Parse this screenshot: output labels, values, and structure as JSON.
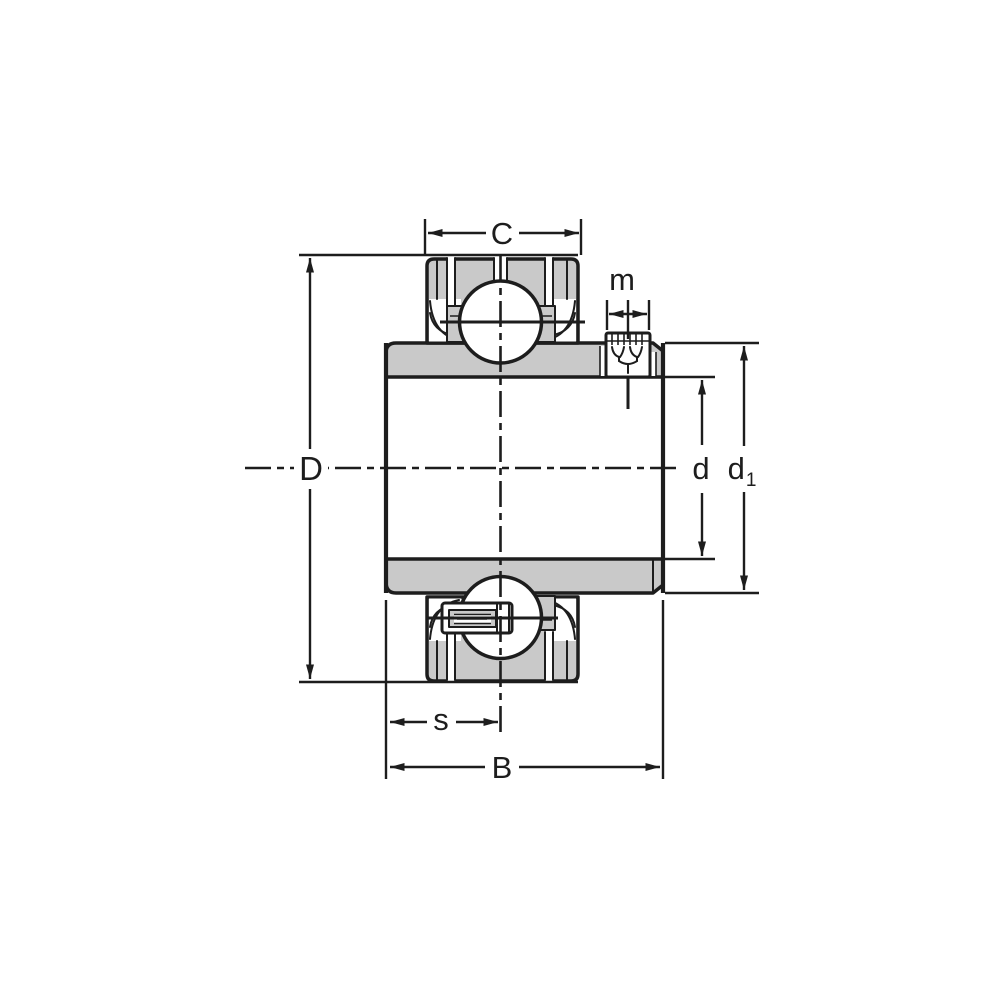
{
  "diagram": {
    "type": "engineering-drawing",
    "subject": "insert-ball-bearing-cross-section",
    "colors": {
      "line": "#1d1d1d",
      "section_fill": "#c9c9c9",
      "background": "#ffffff"
    },
    "dimensions": {
      "C": {
        "label": "C"
      },
      "m": {
        "label": "m"
      },
      "D": {
        "label": "D"
      },
      "d": {
        "label": "d"
      },
      "d1": {
        "base": "d",
        "sub": "1"
      },
      "s": {
        "label": "s"
      },
      "B": {
        "label": "B"
      }
    }
  }
}
